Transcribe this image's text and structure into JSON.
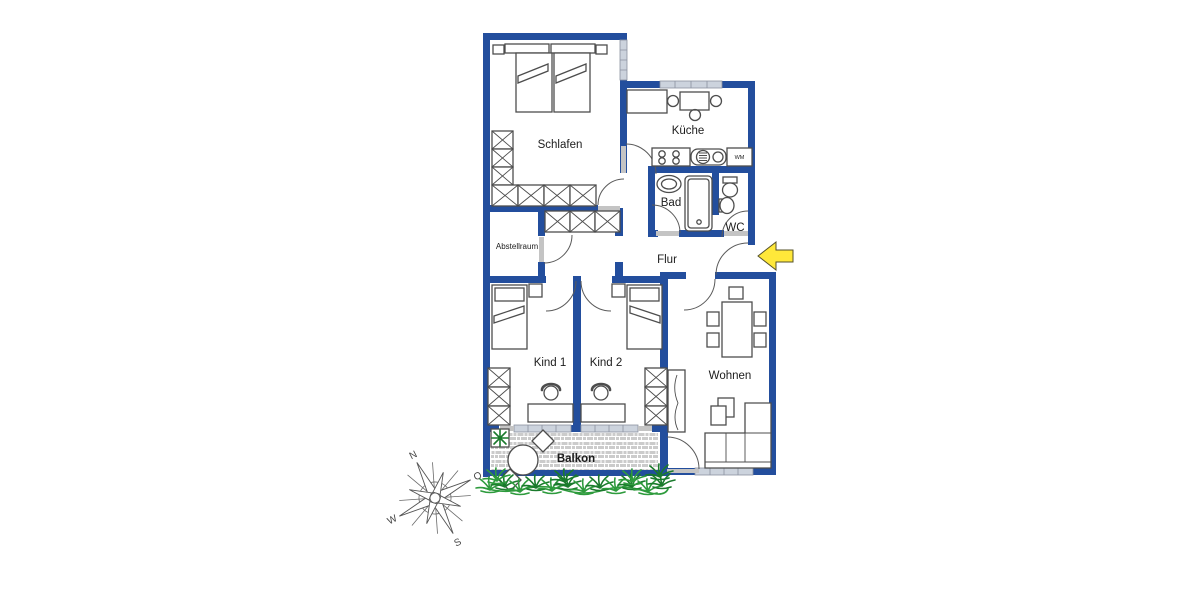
{
  "labels": {
    "schlafen": "Schlafen",
    "kueche": "Küche",
    "bad": "Bad",
    "wc": "WC",
    "flur": "Flur",
    "abstellraum": "Abstellraum",
    "kind1": "Kind 1",
    "kind2": "Kind 2",
    "wohnen": "Wohnen",
    "balkon": "Balkon",
    "wm": "WM"
  },
  "compass": {
    "north": "N",
    "east": "O",
    "south": "S",
    "west": "W"
  },
  "colors": {
    "wall": "#234E9D",
    "furniture": "#4d4d4d",
    "window_fill": "#ccd3dd",
    "window_stroke": "#8a92a0",
    "threshold": "#c4c4c4",
    "grass": "#2E9B3D",
    "grass_dark": "#1a7a2c",
    "arrow_fill": "#FFE83A",
    "tile": "#cbcbcb",
    "text": "#1c1c1c"
  }
}
